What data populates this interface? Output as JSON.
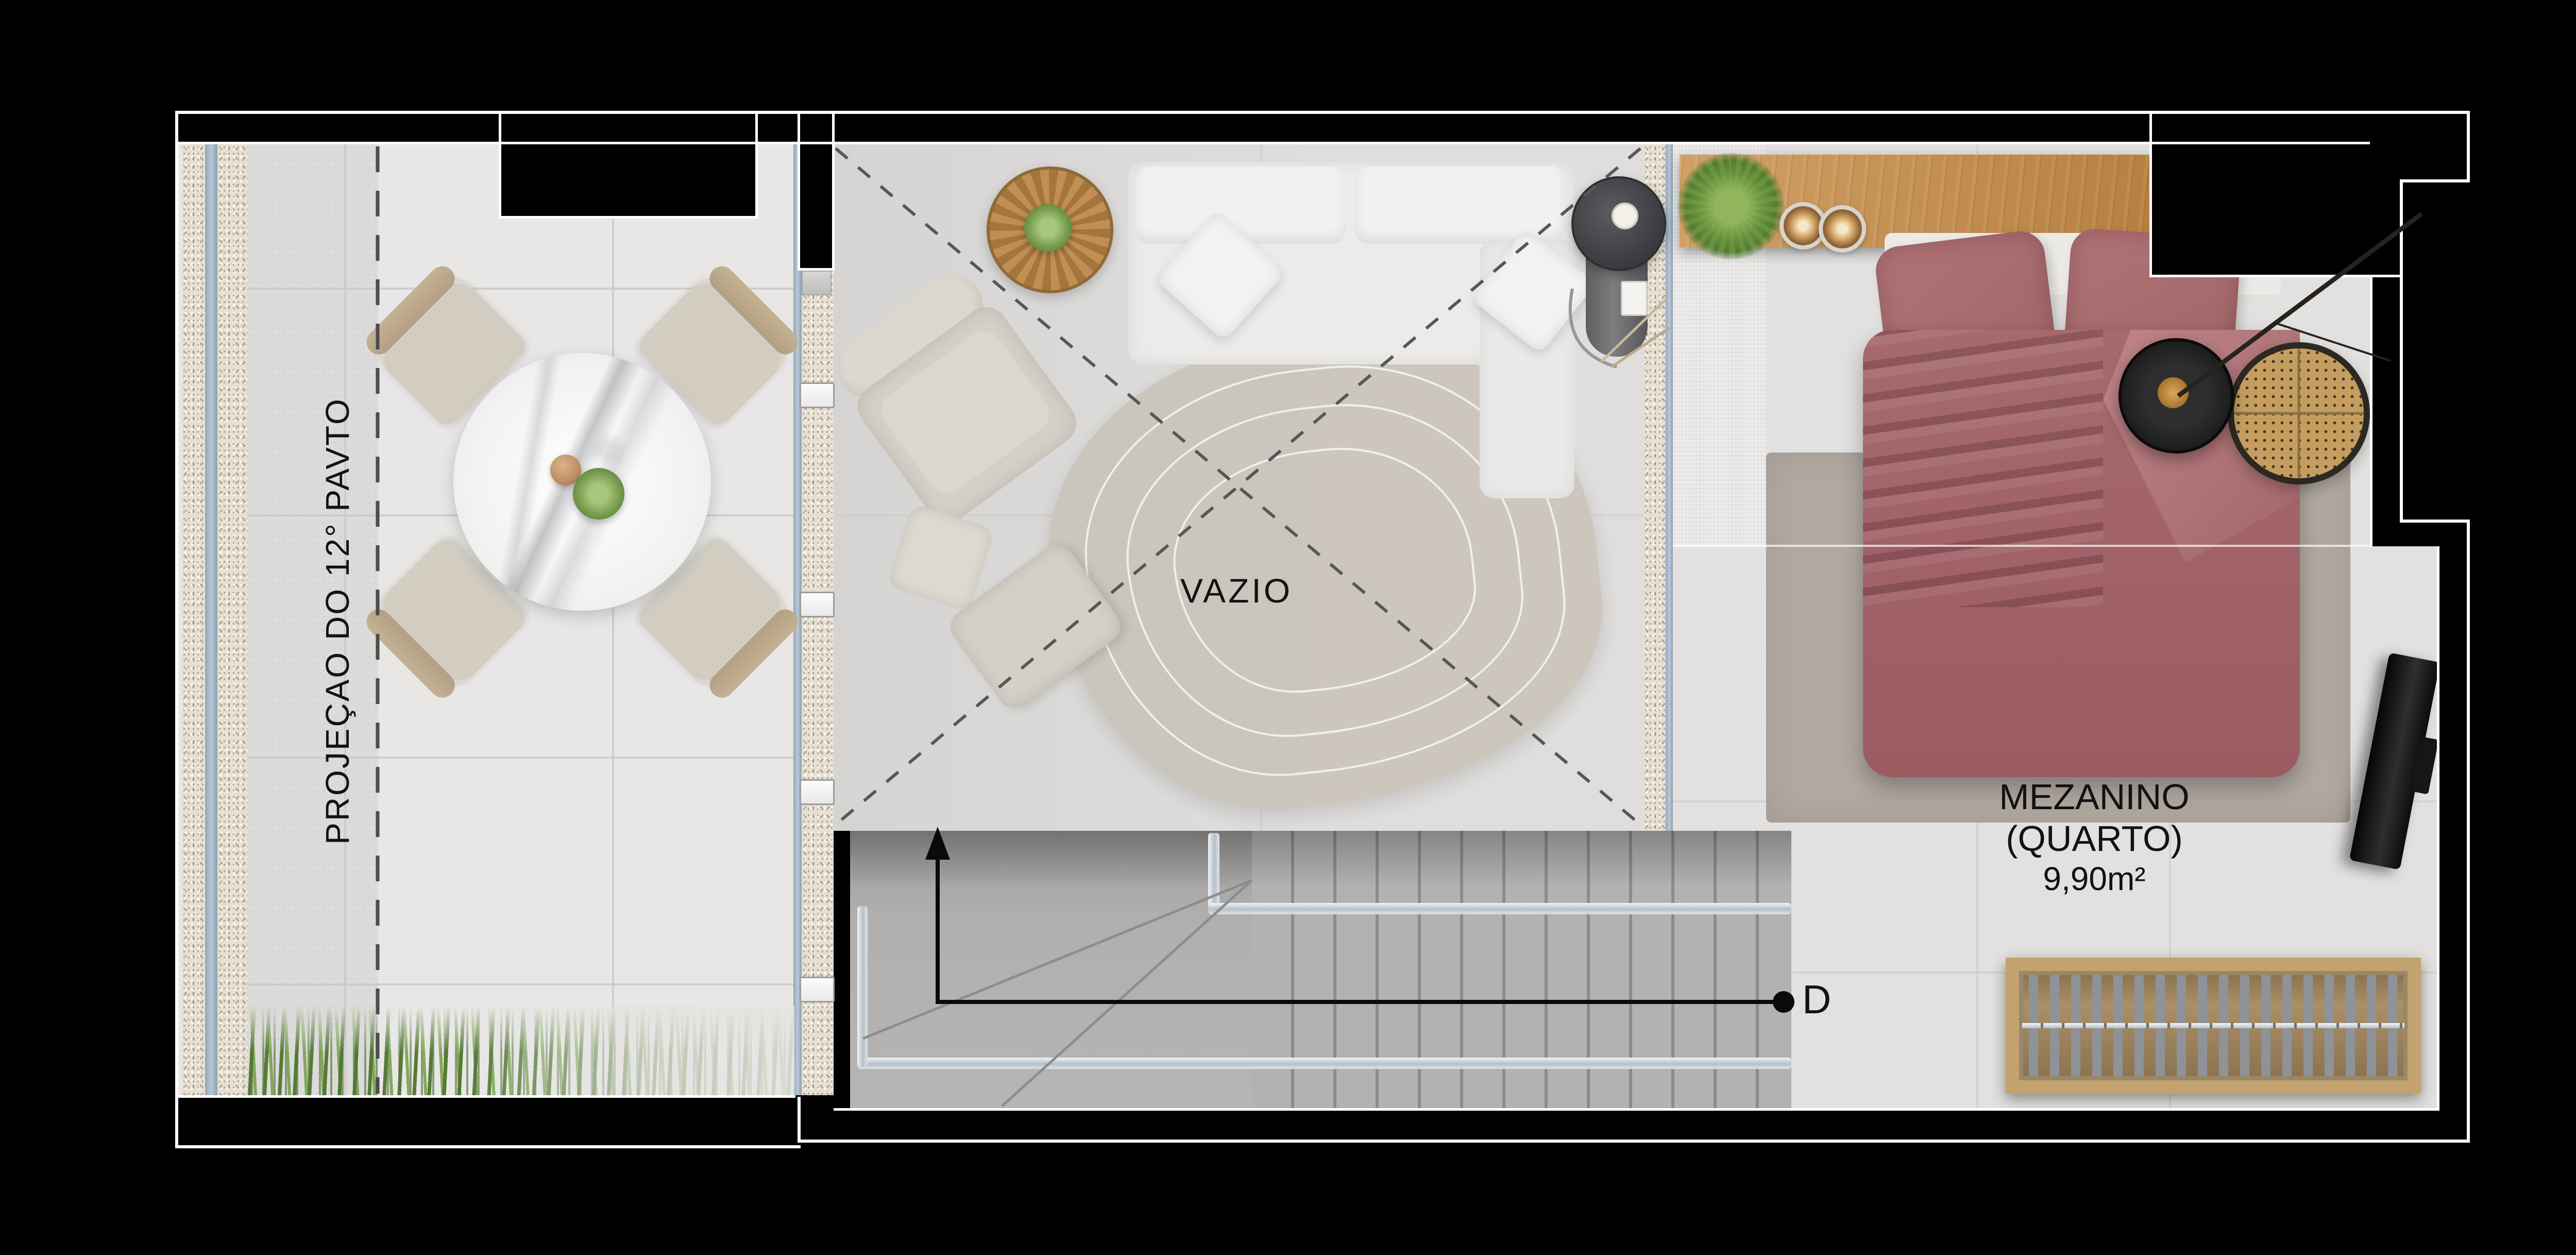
{
  "labels": {
    "projection": "PROJEÇAO DO 12° PAVTO",
    "void": "VAZIO",
    "section_marker": "D"
  },
  "bedroom": {
    "title": "MEZANINO",
    "subtitle": "(QUARTO)",
    "area": "9,90m²"
  },
  "colors": {
    "background": "#000000",
    "wall_outline": "#ffffff",
    "floor_terrace": "#e8e7e5",
    "floor_void": "#dddcda",
    "floor_bedroom": "#e2e1df",
    "stairs": "#b4b3b2",
    "handrail": "#ccd4da",
    "rug_void": "#cbc5bc",
    "rug_bedroom": "#b2a9a1",
    "bed": "#a2646a",
    "sofa": "#ecebe9",
    "desk_wood": "#c69257",
    "bench_wood": "#c2a26f",
    "rattan_chair": "#c59e5f",
    "plants": "#76a04c",
    "glass_partition": "#aab9c9",
    "marble_table": "#f4f3f2",
    "annotation": "#111111"
  }
}
